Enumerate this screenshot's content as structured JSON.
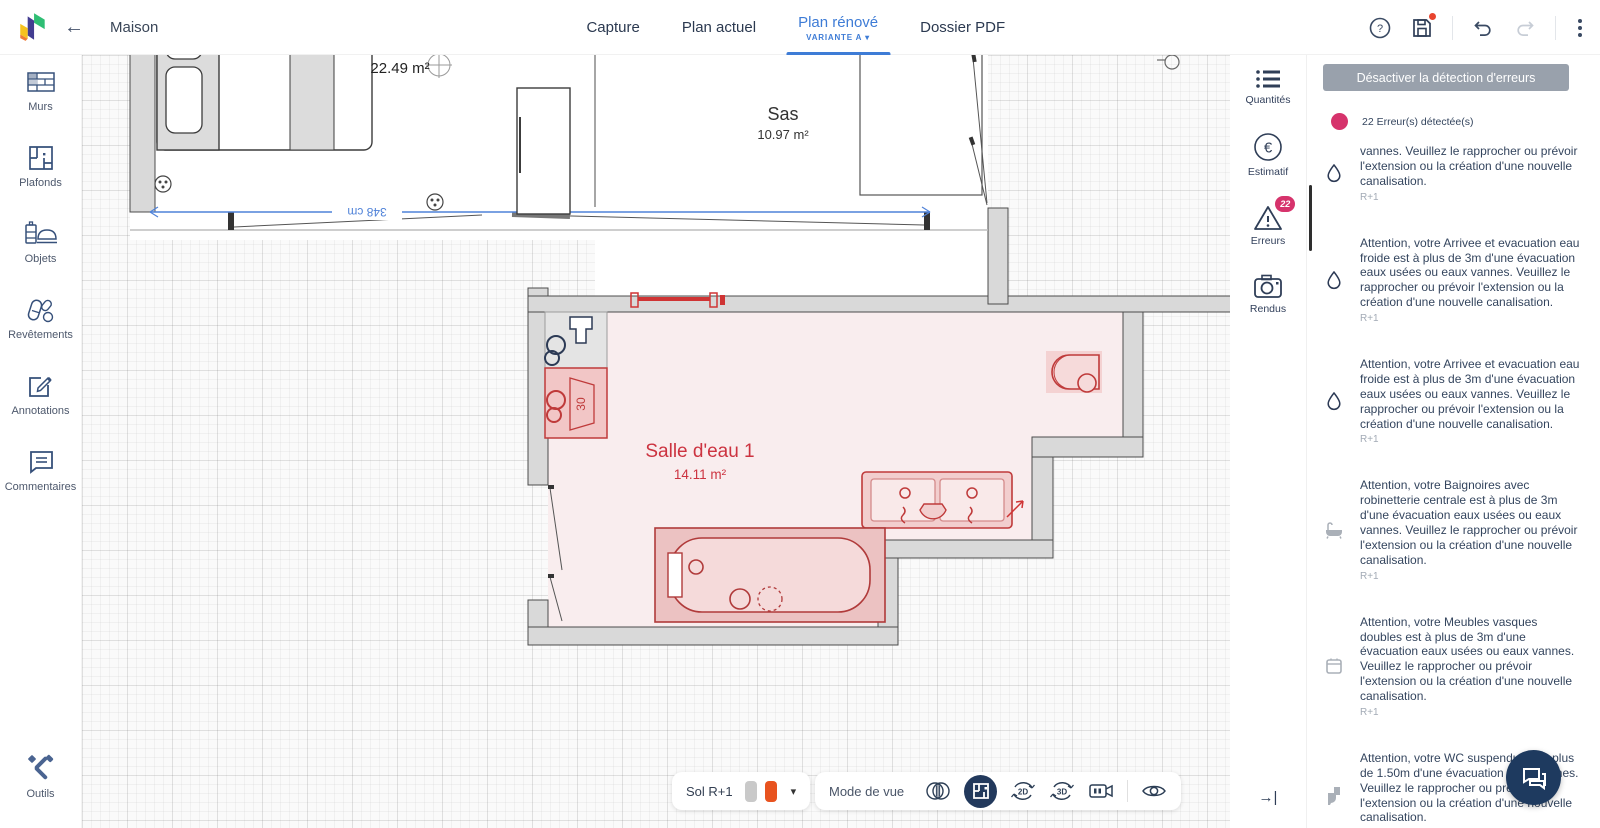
{
  "topbar": {
    "title": "Maison",
    "tabs": [
      {
        "label": "Capture",
        "active": false
      },
      {
        "label": "Plan actuel",
        "active": false
      },
      {
        "label": "Plan rénové",
        "active": true,
        "variant": "VARIANTE A"
      },
      {
        "label": "Dossier PDF",
        "active": false
      }
    ]
  },
  "sidebar": {
    "items": [
      {
        "label": "Murs"
      },
      {
        "label": "Plafonds"
      },
      {
        "label": "Objets"
      },
      {
        "label": "Revêtements"
      },
      {
        "label": "Annotations"
      },
      {
        "label": "Commentaires"
      }
    ],
    "bottom_item": {
      "label": "Outils"
    }
  },
  "rail": {
    "items": [
      {
        "label": "Quantités"
      },
      {
        "label": "Estimatif"
      },
      {
        "label": "Erreurs",
        "badge": "22"
      },
      {
        "label": "Rendus"
      }
    ]
  },
  "errors_panel": {
    "disable_button": "Désactiver la détection d'erreurs",
    "summary": "22 Erreur(s) détectée(s)",
    "items": [
      {
        "icon": "water-drop",
        "text": "vannes. Veuillez le rapprocher ou prévoir l'extension ou la création d'une nouvelle canalisation.",
        "floor": "R+1"
      },
      {
        "icon": "water-drop",
        "text": "Attention, votre Arrivee et evacuation eau froide est à plus de 3m d'une évacuation eaux usées ou eaux vannes. Veuillez le rapprocher ou prévoir l'extension ou la création d'une nouvelle canalisation.",
        "floor": "R+1"
      },
      {
        "icon": "water-drop",
        "text": "Attention, votre Arrivee et evacuation eau froide est à plus de 3m d'une évacuation eaux usées ou eaux vannes. Veuillez le rapprocher ou prévoir l'extension ou la création d'une nouvelle canalisation.",
        "floor": "R+1"
      },
      {
        "icon": "bathtub",
        "text": "Attention, votre Baignoires avec robinetterie centrale est à plus de 3m d'une évacuation eaux usées ou eaux vannes. Veuillez le rapprocher ou prévoir l'extension ou la création d'une nouvelle canalisation.",
        "floor": "R+1"
      },
      {
        "icon": "vanity",
        "text": "Attention, votre Meubles vasques doubles est à plus de 3m d'une évacuation eaux usées ou eaux vannes. Veuillez le rapprocher ou prévoir l'extension ou la création d'une nouvelle canalisation.",
        "floor": "R+1"
      },
      {
        "icon": "toilet",
        "text": "Attention, votre WC suspendu est à plus de 1.50m d'une évacuation eaux vannes. Veuillez le rapprocher ou prévoir l'extension ou la création d'une nouvelle canalisation.",
        "floor": "R+1"
      }
    ]
  },
  "plan": {
    "bedroom_area": "22.49 m²",
    "sas": {
      "name": "Sas",
      "area": "10.97 m²"
    },
    "salle_deau": {
      "name": "Salle d'eau 1",
      "area": "14.11 m²"
    },
    "dimension_label": "348 cm",
    "washer_label": "30"
  },
  "bottombar": {
    "floor_selector": "Sol R+1",
    "view_mode_label": "Mode de vue",
    "rotate2d_label": "2D",
    "rotate3d_label": "3D"
  },
  "colors": {
    "accent_blue": "#3e7cd6",
    "error_pink": "#d6336c",
    "plan_red": "#c0392b",
    "wall_gray": "#d6d6d6",
    "navy_icon": "#33496b",
    "chip_orange": "#e8531f",
    "fab_navy": "#1e3a5f"
  }
}
